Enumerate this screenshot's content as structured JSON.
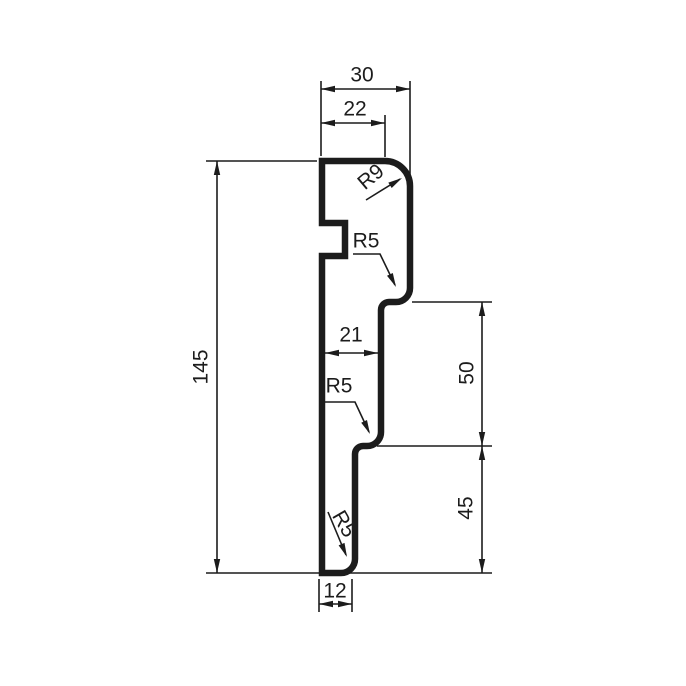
{
  "drawing": {
    "background": "#ffffff",
    "line_color": "#1c1c1c",
    "labels": {
      "width_top": "30",
      "width_top_flat": "22",
      "radius_top": "R9",
      "radius_step1": "R5",
      "height_total": "145",
      "width_mid": "21",
      "radius_step2": "R5",
      "height_upper": "50",
      "height_lower": "45",
      "radius_bottom": "R5",
      "width_bottom": "12"
    }
  }
}
